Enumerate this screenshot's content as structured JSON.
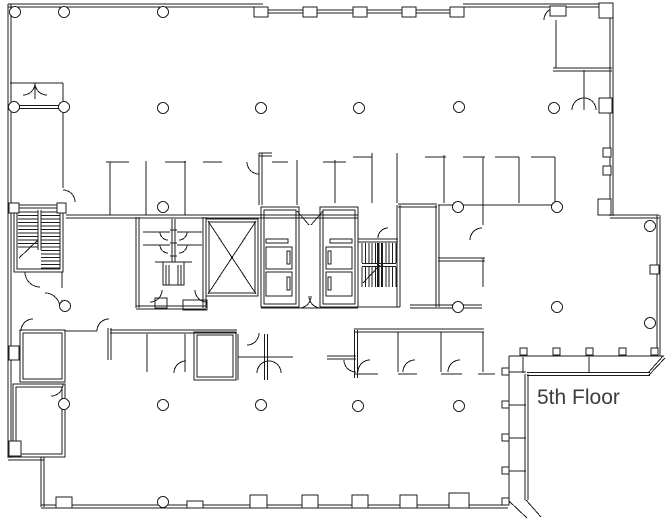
{
  "canvas": {
    "width": 672,
    "height": 520,
    "background": "#ffffff",
    "line_color": "#1c1c1c"
  },
  "title": {
    "label": "5th Floor",
    "x": 537,
    "y": 404,
    "font_size": 21,
    "color": "#3d3d3d"
  },
  "plan": {
    "double_wall_gap": 3,
    "double_walls": [
      [
        8,
        5.5,
        263,
        5.5
      ],
      [
        263,
        11.5,
        463,
        11.5
      ],
      [
        463,
        5.5,
        613,
        5.5
      ],
      [
        9.5,
        4,
        9.5,
        458
      ],
      [
        8,
        458.5,
        44,
        458.5
      ],
      [
        42.5,
        457,
        42.5,
        507
      ],
      [
        41,
        506.5,
        508,
        506.5
      ],
      [
        611.5,
        4,
        611.5,
        216
      ],
      [
        610,
        216.5,
        659,
        216.5
      ],
      [
        658.5,
        215,
        658.5,
        356
      ],
      [
        527,
        374,
        650,
        374
      ],
      [
        526.5,
        374,
        526.5,
        500
      ],
      [
        66,
        216.5,
        358,
        216.5
      ],
      [
        137.5,
        217,
        137.5,
        308
      ],
      [
        204.5,
        217,
        204.5,
        308
      ],
      [
        136,
        307.5,
        206,
        307.5
      ],
      [
        39.5,
        210,
        39.5,
        250
      ],
      [
        260.5,
        153,
        260.5,
        205
      ],
      [
        259,
        154.5,
        272,
        154.5
      ],
      [
        110,
        331.5,
        237,
        331.5
      ],
      [
        109.5,
        328,
        109.5,
        360
      ],
      [
        437.5,
        205,
        437.5,
        307
      ],
      [
        398,
        205.5,
        437,
        205.5
      ],
      [
        438,
        259.5,
        485,
        259.5
      ],
      [
        410,
        306.5,
        482,
        306.5
      ],
      [
        354,
        330.5,
        484,
        330.5
      ],
      [
        356,
        330,
        356,
        378
      ],
      [
        327,
        357.5,
        356,
        357.5
      ],
      [
        266,
        334,
        266,
        380
      ],
      [
        362,
        265,
        396,
        265
      ],
      [
        398.5,
        205,
        398.5,
        307
      ],
      [
        358,
        240.5,
        398,
        240.5
      ],
      [
        553,
        69.5,
        612,
        69.5
      ],
      [
        14,
        107,
        64,
        107
      ],
      [
        173.5,
        219,
        173.5,
        262
      ]
    ],
    "walls": [
      [
        10,
        83,
        63,
        83
      ],
      [
        63,
        83,
        63,
        188
      ],
      [
        35,
        83,
        35,
        99
      ],
      [
        106,
        162,
        129,
        162
      ],
      [
        165,
        162,
        186,
        162
      ],
      [
        203,
        162,
        222,
        162
      ],
      [
        272,
        162,
        288,
        162
      ],
      [
        323,
        162,
        346,
        162
      ],
      [
        110,
        162,
        110,
        215
      ],
      [
        146,
        161,
        146,
        215
      ],
      [
        185,
        161,
        185,
        215
      ],
      [
        297,
        160,
        297,
        205
      ],
      [
        335,
        160,
        335,
        203
      ],
      [
        353,
        157,
        372,
        157
      ],
      [
        425,
        157,
        446,
        157
      ],
      [
        463,
        157,
        485,
        157
      ],
      [
        495,
        157,
        519,
        157
      ],
      [
        531,
        157,
        555,
        157
      ],
      [
        372,
        153,
        372,
        203
      ],
      [
        397,
        153,
        397,
        203
      ],
      [
        444,
        155,
        444,
        203
      ],
      [
        519,
        157,
        519,
        203
      ],
      [
        555,
        157,
        555,
        205
      ],
      [
        483,
        157,
        483,
        225
      ],
      [
        483,
        258,
        483,
        287
      ],
      [
        438,
        205,
        556,
        205
      ],
      [
        62,
        272,
        62,
        288
      ],
      [
        62,
        300,
        62,
        310
      ],
      [
        261,
        308,
        358,
        308
      ],
      [
        358,
        307,
        400,
        307
      ],
      [
        65,
        331,
        97,
        331
      ],
      [
        147,
        334,
        147,
        372
      ],
      [
        185,
        334,
        185,
        372
      ],
      [
        238,
        334,
        238,
        380
      ],
      [
        238,
        357,
        293,
        357
      ],
      [
        398,
        332,
        398,
        372
      ],
      [
        441,
        332,
        441,
        372
      ],
      [
        483,
        332,
        483,
        372
      ],
      [
        354,
        374,
        378,
        374
      ],
      [
        398,
        374,
        417,
        374
      ],
      [
        441,
        374,
        462,
        374
      ],
      [
        478,
        374,
        495,
        374
      ],
      [
        509,
        356,
        664,
        356
      ],
      [
        509,
        356,
        509,
        501
      ],
      [
        648,
        373,
        663,
        356
      ],
      [
        648,
        376,
        665,
        358
      ],
      [
        509,
        501,
        527,
        518
      ],
      [
        526,
        500,
        541,
        517
      ],
      [
        523,
        357,
        523,
        373
      ],
      [
        589,
        357,
        589,
        373
      ],
      [
        509,
        372,
        526,
        372
      ],
      [
        509,
        405,
        526,
        405
      ],
      [
        509,
        438,
        526,
        438
      ],
      [
        509,
        471,
        526,
        471
      ],
      [
        143,
        232,
        170,
        232
      ],
      [
        143,
        245,
        170,
        245
      ],
      [
        177,
        232,
        202,
        232
      ],
      [
        177,
        245,
        202,
        245
      ],
      [
        170,
        230,
        177,
        230
      ],
      [
        170,
        243,
        177,
        243
      ],
      [
        170,
        256,
        177,
        256
      ],
      [
        155,
        262,
        192,
        262
      ],
      [
        166,
        265,
        166,
        285
      ],
      [
        169,
        265,
        169,
        285
      ],
      [
        178,
        265,
        178,
        285
      ],
      [
        181,
        265,
        181,
        285
      ],
      [
        208,
        221,
        256,
        294
      ],
      [
        256,
        221,
        208,
        294
      ],
      [
        19,
        258,
        38,
        240
      ],
      [
        363,
        283,
        380,
        265
      ],
      [
        297,
        211,
        309,
        225
      ],
      [
        323,
        211,
        311,
        225
      ],
      [
        556,
        20,
        556,
        68
      ],
      [
        584,
        70,
        584,
        110
      ]
    ],
    "thick_lines": [
      [
        378,
        243,
        378,
        287
      ],
      [
        382,
        243,
        382,
        287
      ]
    ],
    "rects": [
      [
        206,
        219,
        52,
        77
      ],
      [
        209,
        222,
        46,
        71
      ],
      [
        261,
        207,
        38,
        100
      ],
      [
        264,
        210,
        32,
        94
      ],
      [
        320,
        207,
        38,
        100
      ],
      [
        323,
        210,
        32,
        94
      ],
      [
        14,
        205,
        49,
        67
      ],
      [
        17,
        208,
        43,
        61
      ],
      [
        266,
        247,
        26,
        22
      ],
      [
        266,
        272,
        26,
        24
      ],
      [
        326,
        247,
        26,
        22
      ],
      [
        326,
        272,
        26,
        24
      ],
      [
        287,
        251,
        3,
        13
      ],
      [
        287,
        277,
        3,
        13
      ],
      [
        328,
        251,
        3,
        13
      ],
      [
        328,
        277,
        3,
        13
      ],
      [
        266,
        239,
        22,
        4
      ],
      [
        330,
        239,
        22,
        4
      ],
      [
        163,
        262,
        21,
        23
      ],
      [
        20,
        330,
        45,
        52
      ],
      [
        23,
        333,
        39,
        46
      ],
      [
        13,
        384,
        52,
        73
      ],
      [
        16,
        387,
        46,
        67
      ],
      [
        194,
        332,
        42,
        48
      ],
      [
        197,
        335,
        36,
        42
      ],
      [
        155,
        298,
        12,
        10
      ],
      [
        183,
        300,
        24,
        10
      ]
    ],
    "mullions": [
      [
        254,
        7,
        14,
        10
      ],
      [
        303,
        7,
        14,
        10
      ],
      [
        353,
        7,
        14,
        10
      ],
      [
        402,
        7,
        14,
        10
      ],
      [
        450,
        7,
        14,
        10
      ],
      [
        550,
        6,
        16,
        10
      ],
      [
        599,
        3,
        14,
        15
      ],
      [
        56,
        497,
        16,
        11
      ],
      [
        187,
        501,
        16,
        7
      ],
      [
        250,
        495,
        17,
        13
      ],
      [
        302,
        495,
        16,
        13
      ],
      [
        352,
        495,
        16,
        13
      ],
      [
        400,
        495,
        17,
        13
      ],
      [
        449,
        493,
        20,
        15
      ],
      [
        599,
        98,
        13,
        15
      ],
      [
        598,
        199,
        13,
        16
      ],
      [
        603,
        148,
        8,
        9
      ],
      [
        603,
        166,
        8,
        9
      ],
      [
        650,
        265,
        9,
        9
      ],
      [
        9,
        203,
        10,
        10
      ],
      [
        57,
        203,
        9,
        10
      ],
      [
        9,
        346,
        10,
        14
      ],
      [
        9,
        441,
        12,
        15
      ],
      [
        520,
        348,
        7,
        7
      ],
      [
        553,
        348,
        7,
        7
      ],
      [
        586,
        348,
        7,
        7
      ],
      [
        619,
        348,
        7,
        7
      ],
      [
        651,
        348,
        7,
        7
      ],
      [
        502,
        368,
        7,
        7
      ],
      [
        502,
        401,
        7,
        7
      ],
      [
        502,
        434,
        7,
        7
      ],
      [
        502,
        467,
        7,
        7
      ],
      [
        502,
        498,
        7,
        7
      ]
    ],
    "column_radius": 5.5,
    "columns": [
      [
        15,
        12
      ],
      [
        64,
        12
      ],
      [
        163,
        12
      ],
      [
        14,
        107
      ],
      [
        64,
        107
      ],
      [
        163,
        108
      ],
      [
        261,
        108
      ],
      [
        359,
        108
      ],
      [
        459,
        107
      ],
      [
        554,
        108
      ],
      [
        163,
        207
      ],
      [
        458,
        207
      ],
      [
        557,
        207
      ],
      [
        650,
        226
      ],
      [
        65,
        306
      ],
      [
        458,
        307
      ],
      [
        557,
        307
      ],
      [
        650,
        323
      ],
      [
        64,
        404
      ],
      [
        163,
        405
      ],
      [
        261,
        405
      ],
      [
        358,
        406
      ],
      [
        459,
        406
      ],
      [
        163,
        502
      ]
    ],
    "stair_combs": [
      {
        "orient": "h",
        "from": 18,
        "to": 38,
        "start": 212,
        "n": 11,
        "step": 3.5
      },
      {
        "orient": "h",
        "from": 41,
        "to": 60,
        "start": 212,
        "n": 17,
        "step": 3.5
      },
      {
        "orient": "v",
        "from": 243,
        "to": 263,
        "start": 362,
        "n": 11,
        "step": 3.4
      },
      {
        "orient": "v",
        "from": 267,
        "to": 287,
        "start": 362,
        "n": 11,
        "step": 3.4
      }
    ],
    "door_arcs": [
      "M35,83 A12,12 0 0 1 23,95",
      "M47,95 A12,12 0 0 1 35,83",
      "M63,190 A12,12 0 0 1 75,202",
      "M97,331 A12,12 0 0 1 109,319",
      "M259,174 A12,12 0 0 1 247,162",
      "M544,20 A12,12 0 0 1 556,8",
      "M572,110 A12,12 0 0 1 584,98",
      "M584,98 A12,12 0 0 1 596,110",
      "M311,296 A12,12 0 0 1 299,308",
      "M321,308 A12,12 0 0 1 309,296",
      "M162,290 A12,12 0 0 1 150,302",
      "M207,302 A12,12 0 0 1 195,290",
      "M40,287 A15,15 0 0 1 25,272",
      "M45,293 A15,15 0 0 1 60,308",
      "M21,331 A12,12 0 0 1 33,319",
      "M63,384 A12,12 0 0 1 51,396",
      "M174,373 A12,12 0 0 1 186,361",
      "M259,333 A12,12 0 0 1 247,345",
      "M257,373 A12,12 0 0 1 269,361",
      "M269,361 A12,12 0 0 1 281,373",
      "M358,372 A12,12 0 0 1 370,360",
      "M403,372 A12,12 0 0 1 415,360",
      "M448,372 A12,12 0 0 1 460,360",
      "M356,372 A12,12 0 0 1 344,360",
      "M470,240 A12,12 0 0 1 482,228",
      "M378,238 A10,10 0 0 1 388,228",
      "M168,240 A8,8 0 0 1 160,232",
      "M168,253 A8,8 0 0 1 160,245",
      "M187,232 A8,8 0 0 1 179,240",
      "M187,245 A8,8 0 0 1 179,253"
    ]
  }
}
